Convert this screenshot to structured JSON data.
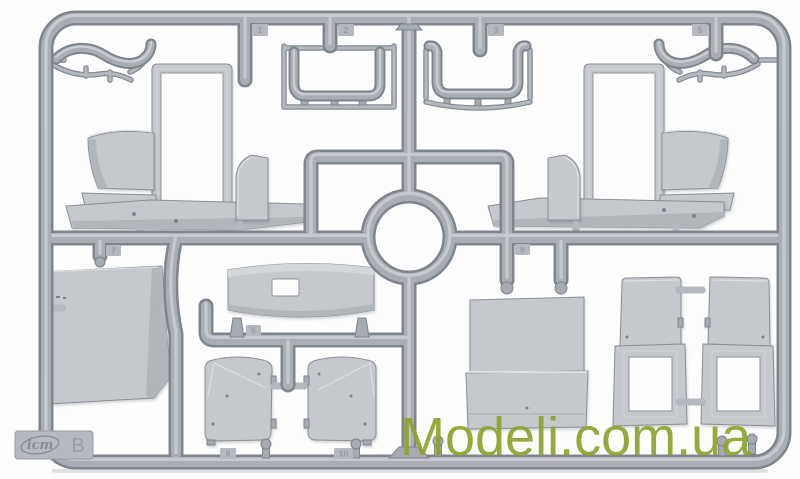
{
  "meta": {
    "description": "Product photo of a gray injection-molded plastic model kit sprue (runner frame B) with cab panels, doors, running boards and window frames, on a white background",
    "background": "#fdfdfd"
  },
  "watermark": {
    "text": "Modeli.com.ua",
    "color": "#8DA32D"
  },
  "sprue": {
    "plastic": {
      "base": "#a9aeb5",
      "edge": "#7f858d",
      "highlight": "#ccd0d4",
      "panel": "#c5c8cc",
      "panel_shade": "#b1b6bb",
      "panel_light": "#d4d7da"
    },
    "brand_tab": {
      "logo_text": "icm",
      "sprue_letter": "B"
    },
    "part_tags": [
      {
        "label": "1"
      },
      {
        "label": "2"
      },
      {
        "label": "3"
      },
      {
        "label": "5"
      },
      {
        "label": "6"
      },
      {
        "label": "7"
      },
      {
        "label": "8"
      },
      {
        "label": "9"
      },
      {
        "label": "10"
      }
    ]
  }
}
